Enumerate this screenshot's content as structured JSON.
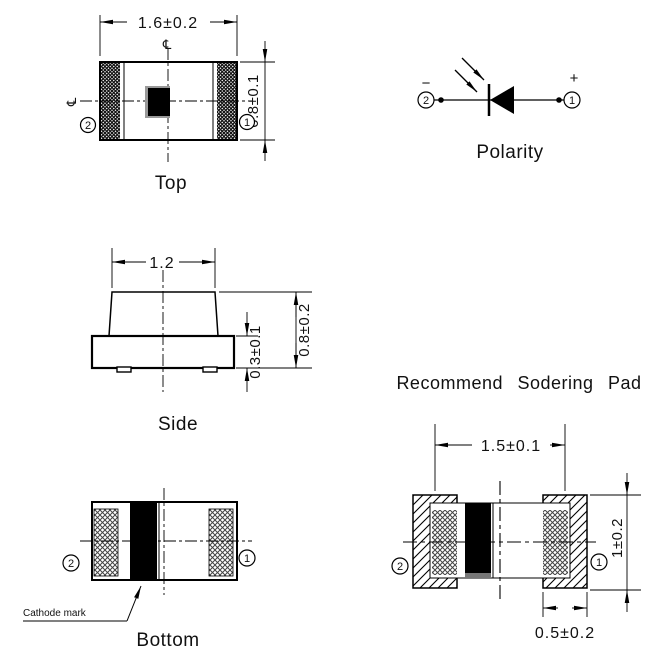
{
  "pins": {
    "cathode": "2",
    "anode": "1"
  },
  "views": {
    "top": {
      "label": "Top",
      "width_dim": "1.6±0.2",
      "height_dim": "0.8±0.1",
      "centerline_symbol": "℄"
    },
    "polarity": {
      "label": "Polarity",
      "negative_sign": "−",
      "positive_sign": "+"
    },
    "side": {
      "label": "Side",
      "top_width_dim": "1.2",
      "base_thickness_dim": "0.3±0.1",
      "overall_height_dim": "0.8±0.2"
    },
    "bottom": {
      "label": "Bottom",
      "cathode_note": "Cathode mark"
    },
    "solder_pad": {
      "title": "Recommend Sodering Pad",
      "pad_pitch_dim": "1.5±0.1",
      "pad_height_dim": "1±0.2",
      "pad_width_dim": "0.5±0.2"
    }
  },
  "colors": {
    "line": "#000000",
    "background": "#ffffff",
    "cathode_mark": "#000000",
    "chip_shadow": "#999999"
  }
}
